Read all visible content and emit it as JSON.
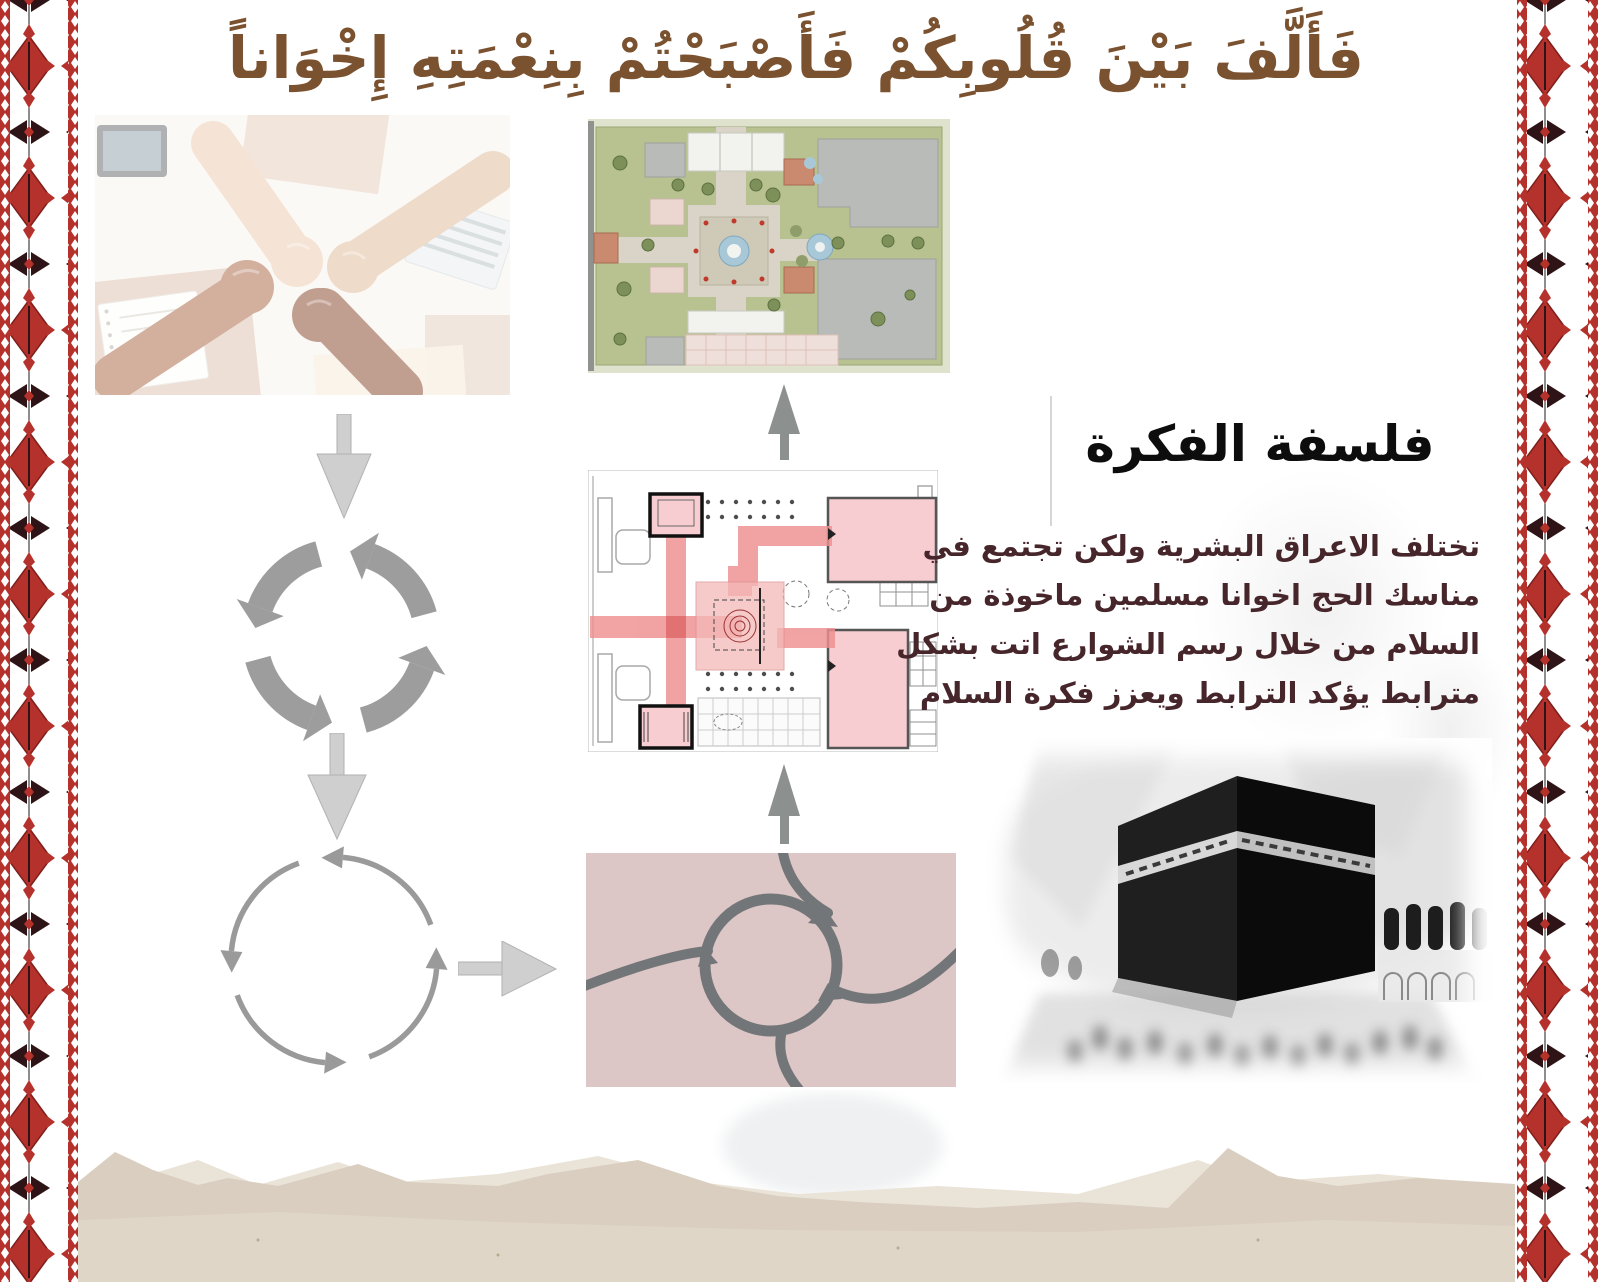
{
  "slide": {
    "title_verse": "فَأَلَّفَ بَيْنَ قُلُوبِكُمْ فَأَصْبَحْتُمْ بِنِعْمَتِهِ إِخْوَاناً",
    "concept": {
      "heading": "فلسفة الفكرة",
      "body_lines": [
        "تختلف الاعراق البشرية ولكن تجتمع في",
        "مناسك الحج اخوانا مسلمين ماخوذة من",
        "السلام من خلال رسم الشوارع اتت بشكل",
        "مترابط يؤكد الترابط ويعزز فكرة السلام"
      ]
    },
    "figures": {
      "hands": "clasped-hands-unity-photo",
      "site_plan": "landscape-site-plan",
      "floor_plan": "circulation-floor-plan",
      "roads": "roundabout-road-network-diagram",
      "kaaba": "kaaba-pilgrims-photo",
      "borders": "tatreez-embroidery-border",
      "landscape": "desert-mountains-watercolor"
    },
    "colors": {
      "title_brown": "#7a5230",
      "body_maroon": "#46262b",
      "heading_black": "#0d0d0d",
      "tatreez_red": "#b5312c",
      "tatreez_dark": "#2e1416",
      "diagram_gray": "#9d9d9d",
      "light_arrow_gray": "#cfcfcf",
      "roads_pink": "#dcc6c6",
      "road_gray": "#737678",
      "plan_red": "#ef8f8f",
      "plan_pink": "#f8cdd1",
      "lawn_green": "#b7c290",
      "building_gray": "#b9bbb8",
      "mountain_tan": "#d9cec0"
    }
  }
}
